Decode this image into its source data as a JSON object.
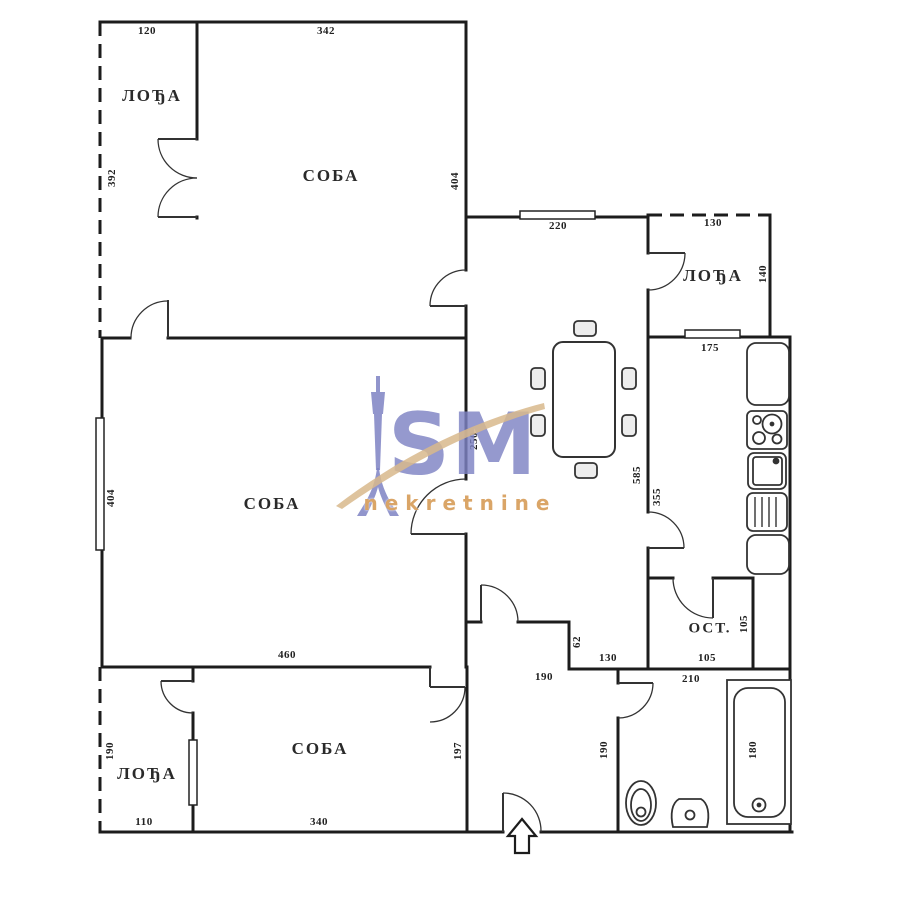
{
  "watermark": {
    "logo_text": "SM",
    "tagline": "nekretnine",
    "brand_purple": "#7e82c3",
    "brand_tan": "#d8a968"
  },
  "colors": {
    "line": "#1c1c1c"
  },
  "rooms": {
    "loggia_top_left": "ЛОЂА",
    "room_top": "СОБА",
    "loggia_top_right": "ЛОЂА",
    "room_central": "СОБА",
    "pantry": "ОСТ.",
    "room_bottom": "СОБА",
    "loggia_bottom_left": "ЛОЂА"
  },
  "dims": {
    "d_tl_loggia_w": "120",
    "d_top_room_w": "342",
    "d_left_upper_h": "392",
    "d_top_room_h": "404",
    "d_dining_window": "220",
    "d_tr_loggia_w": "130",
    "d_tr_loggia_h": "140",
    "d_kitchen_window": "175",
    "d_central_left_h": "404",
    "d_dining_wall": "250",
    "d_dining_h": "585",
    "d_kitchen_h": "355",
    "d_wall_62": "62",
    "d_hall_130": "130",
    "d_hall_190": "190",
    "d_pantry_h": "105",
    "d_pantry_w": "105",
    "d_bath_w": "210",
    "d_bottom_room_h": "197",
    "d_bath_left_h": "190",
    "d_tub_h": "180",
    "d_bl_loggia_h": "190",
    "d_bl_loggia_w": "110",
    "d_bottom_room_w": "340",
    "d_central_w": "460"
  }
}
